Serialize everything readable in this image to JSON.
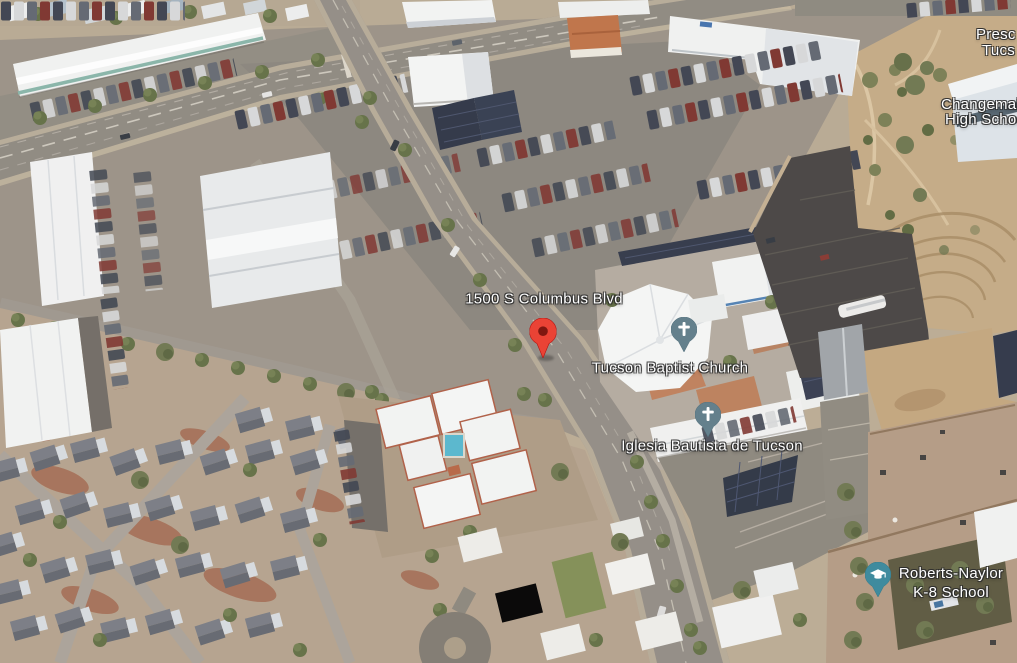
{
  "view": {
    "mode_label": "satellite-3d-aerial",
    "address_marker": {
      "label": "1500 S Columbus Blvd",
      "pin_color": "#EA4335",
      "pin_dot_color": "#7F1710"
    },
    "pois": {
      "tucson_baptist_church": {
        "label": "Tucson Baptist Church",
        "icon": "church-cross",
        "marker_color": "#64808C"
      },
      "iglesia_bautista": {
        "label": "Iglesia Bautista de Tucson",
        "icon": "church-cross",
        "marker_color": "#64808C"
      },
      "roberts_naylor": {
        "line1": "Roberts-Naylor",
        "line2": "K-8 School",
        "icon": "graduation-cap",
        "marker_color": "#3F8B9E"
      },
      "changemaker": {
        "line1": "Changemaker",
        "line2": "High School"
      },
      "clipped_right_edge": {
        "line1": "Presc",
        "line2": "Tucs"
      }
    }
  }
}
